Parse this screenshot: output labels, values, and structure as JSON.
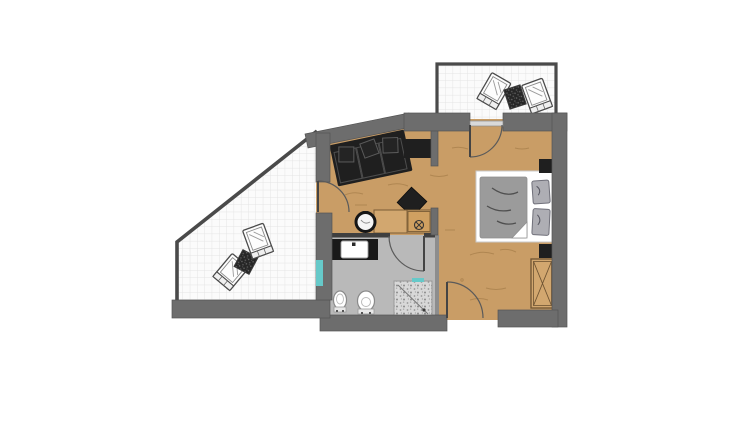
{
  "plan": {
    "kind": "apartment-floor-plan",
    "visible_text": [],
    "rooms": [
      {
        "name": "terrace-upper",
        "floor": "white-tile-grid",
        "furniture": [
          "deck-chair",
          "patio-side-table",
          "deck-chair"
        ]
      },
      {
        "name": "terrace-lower",
        "floor": "white-tile-grid",
        "furniture": [
          "deck-chair",
          "patio-side-table",
          "deck-chair"
        ]
      },
      {
        "name": "living-area",
        "floor": "wood",
        "furniture": [
          "sofa",
          "sideboard",
          "square-side-table",
          "round-washbasin",
          "kitchenette-counter",
          "cooktop-unit"
        ]
      },
      {
        "name": "bedroom",
        "floor": "wood",
        "furniture": [
          "double-bed",
          "duvet",
          "pillow",
          "pillow",
          "nightstand",
          "nightstand",
          "wardrobe"
        ]
      },
      {
        "name": "bathroom",
        "floor": "stone-gray",
        "furniture": [
          "vanity-counter",
          "washbasin",
          "bidet",
          "toilet",
          "shower"
        ]
      },
      {
        "name": "entry-hall",
        "floor": "wood",
        "furniture": []
      }
    ],
    "doors": [
      "terrace-door-living",
      "terrace-door-bedroom",
      "bathroom-door",
      "entry-door"
    ],
    "glass_elements": [
      "bathroom-glass-panel",
      "shower-glass-panel",
      "bedroom-terrace-glass-sill"
    ]
  },
  "colors": {
    "background": "#ffffff",
    "wall": "#6d6d6d",
    "wall_outline": "#4a4a4a",
    "thin_wall": "#8d8d8d",
    "wood_floor": "#c99d66",
    "wood_grain": "#8a6433",
    "counter_wood": "#d2a76f",
    "tile_floor": "#fbfbfb",
    "tile_grid": "#e4e4e4",
    "bath_floor": "#b9b9b9",
    "bath_wall_line": "#3f3f3f",
    "dark_furniture": "#1f1f1f",
    "bed_linen": "#9b9b9b",
    "pillow": "#aeaeb4",
    "bed_frame": "#ffffff",
    "shower_tile": "#d8d8d8",
    "glass_accent": "#66c9c9",
    "fixture_white": "#ffffff",
    "door_arc": "#5a5a5a"
  }
}
